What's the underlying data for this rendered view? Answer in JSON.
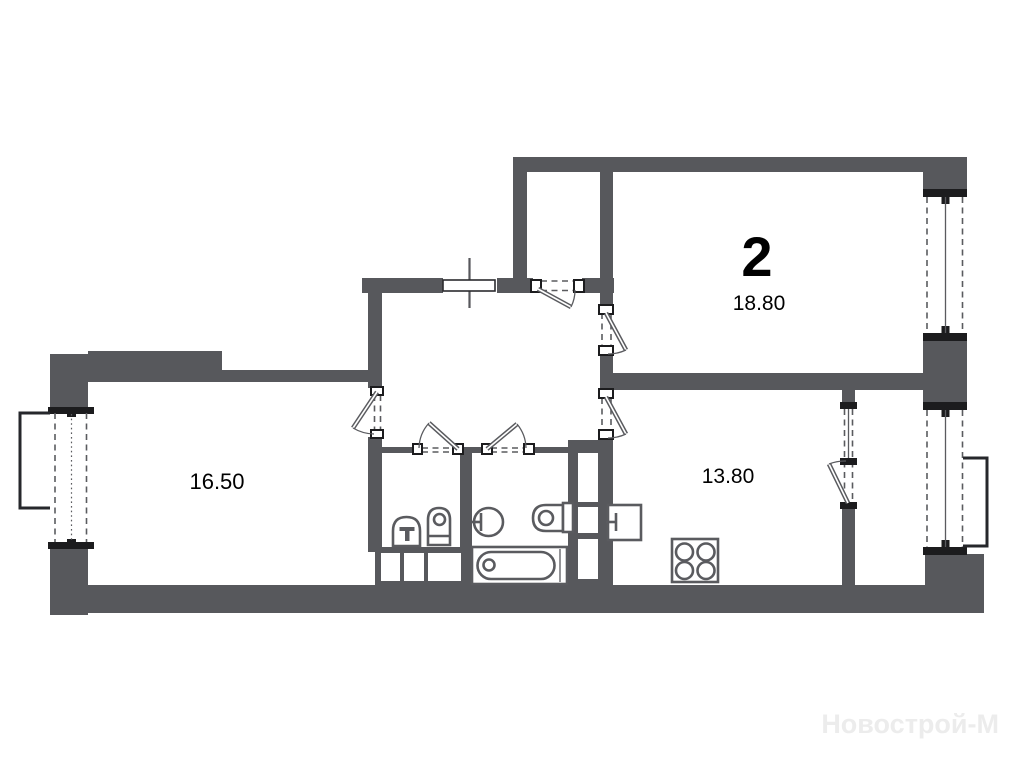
{
  "plan": {
    "type": "apartment-floor-plan",
    "rooms": [
      {
        "name": "living-room",
        "number": "2",
        "area": "18.80"
      },
      {
        "name": "bedroom",
        "area": "16.50"
      },
      {
        "name": "kitchen",
        "area": "13.80"
      }
    ],
    "watermark": "Новострой-М",
    "colors": {
      "wall": "#57585c",
      "outline": "#5a5b5f",
      "cap": "#1c1c1e",
      "label": "#000000",
      "watermark": "#ececec",
      "background": "#ffffff"
    }
  }
}
